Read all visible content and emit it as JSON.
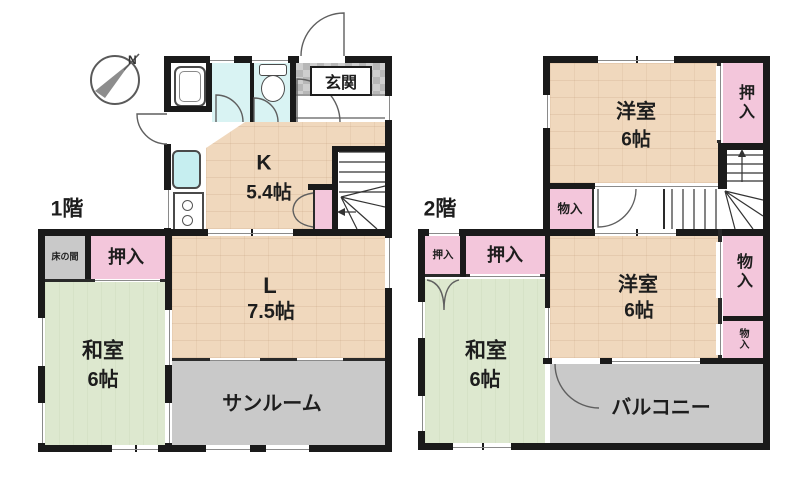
{
  "compass": {
    "north": "N"
  },
  "floor1": {
    "label": "1階",
    "entrance": {
      "label": "玄関"
    },
    "kitchen": {
      "name": "K",
      "size": "5.4帖"
    },
    "living": {
      "name": "L",
      "size": "7.5帖"
    },
    "japanese_room": {
      "name": "和室",
      "size": "6帖"
    },
    "sunroom": {
      "label": "サンルーム"
    },
    "closet": {
      "label": "押入"
    },
    "tokonoma": {
      "label": "床の間"
    }
  },
  "floor2": {
    "label": "2階",
    "western_room_north": {
      "name": "洋室",
      "size": "6帖"
    },
    "closet_north": {
      "label": "押入"
    },
    "hall_storage": {
      "label": "物入"
    },
    "closet_small": {
      "label": "押入"
    },
    "closet_main": {
      "label": "押入"
    },
    "japanese_room": {
      "name": "和室",
      "size": "6帖"
    },
    "western_room_south": {
      "name": "洋室",
      "size": "6帖"
    },
    "storage_east_large": {
      "label": "物入"
    },
    "storage_east_small": {
      "label": "物入"
    },
    "balcony": {
      "label": "バルコニー"
    }
  },
  "colors": {
    "wall": "#1a1a1a",
    "wood_floor": "#f0d8bd",
    "tatami": "#dde8cf",
    "closet": "#f3c6db",
    "water": "#d9f3f3",
    "gray_area": "#c9c9c9"
  }
}
